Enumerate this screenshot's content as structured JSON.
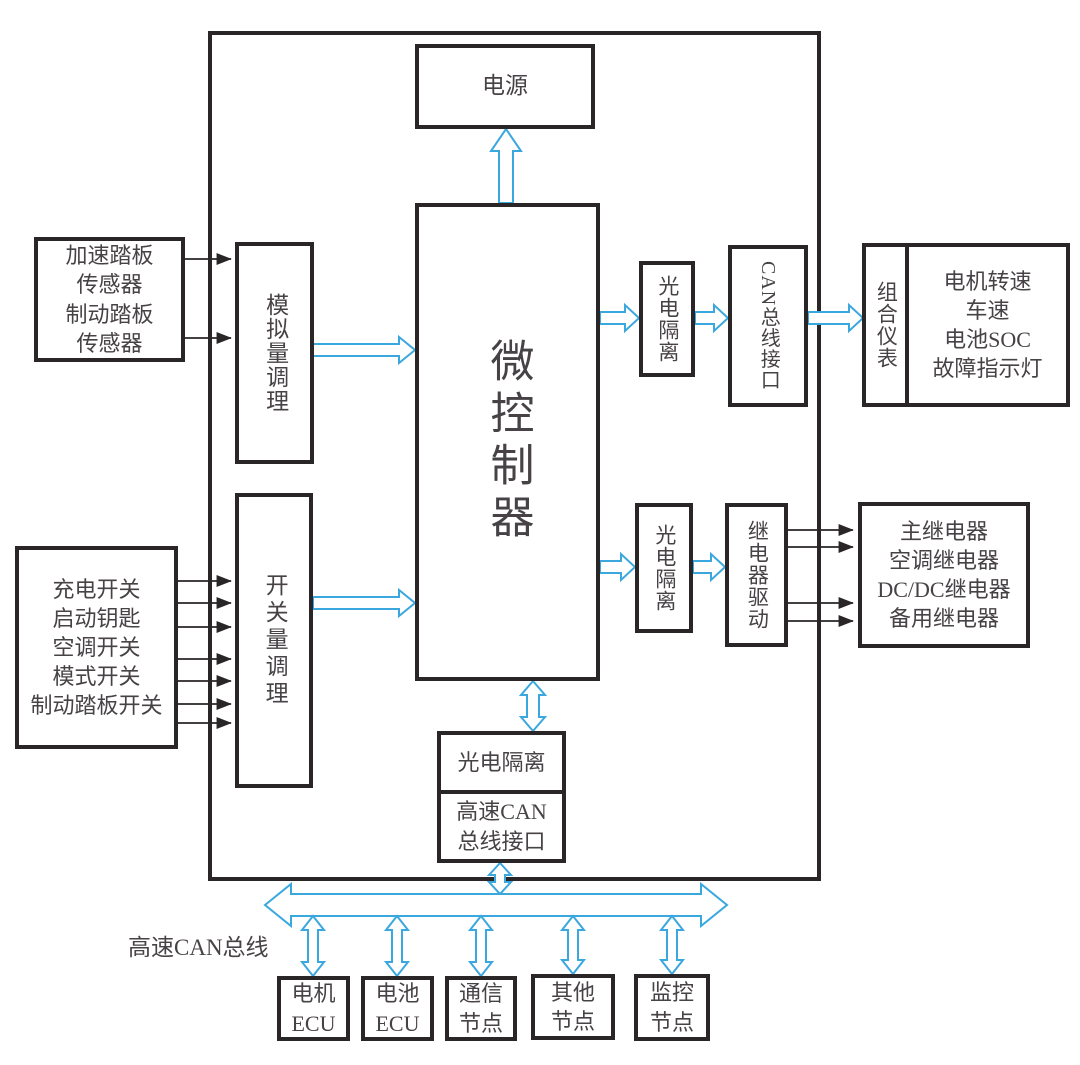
{
  "diagram": {
    "colors": {
      "line_black": "#2a2526",
      "arrow_blue": "#3aa7de",
      "text_gray": "#474245"
    },
    "boxes": {
      "power": {
        "label": "电源"
      },
      "mcu": {
        "label": "微控制器"
      },
      "analog_cond": {
        "label": "模拟量调理"
      },
      "switch_cond": {
        "label": "开关量调理"
      },
      "pedal_sensors": {
        "lines": [
          "加速踏板",
          "传感器",
          "制动踏板",
          "传感器"
        ]
      },
      "switch_inputs": {
        "lines": [
          "充电开关",
          "启动钥匙",
          "空调开关",
          "模式开关",
          "制动踏板开关"
        ]
      },
      "opto_iso_top": {
        "label": "光电隔离"
      },
      "can_bus_if": {
        "label": "CAN总线接口"
      },
      "cluster": {
        "label": "组合仪表"
      },
      "cluster_display": {
        "lines": [
          "电机转速",
          "车速",
          "电池SOC",
          "故障指示灯"
        ]
      },
      "opto_iso_mid": {
        "label": "光电隔离"
      },
      "relay_drive": {
        "label": "继电器驱动"
      },
      "relays": {
        "lines": [
          "主继电器",
          "空调继电器",
          "DC/DC继电器",
          "备用继电器"
        ]
      },
      "opto_iso_bottom": {
        "label": "光电隔离"
      },
      "hs_can_if": {
        "lines": [
          "高速CAN",
          "总线接口"
        ]
      },
      "motor_ecu": {
        "lines": [
          "电机",
          "ECU"
        ]
      },
      "battery_ecu": {
        "lines": [
          "电池",
          "ECU"
        ]
      },
      "comm_node": {
        "lines": [
          "通信",
          "节点"
        ]
      },
      "other_node": {
        "lines": [
          "其他",
          "节点"
        ]
      },
      "monitor_node": {
        "lines": [
          "监控",
          "节点"
        ]
      }
    },
    "bus": {
      "label": "高速CAN总线"
    }
  }
}
